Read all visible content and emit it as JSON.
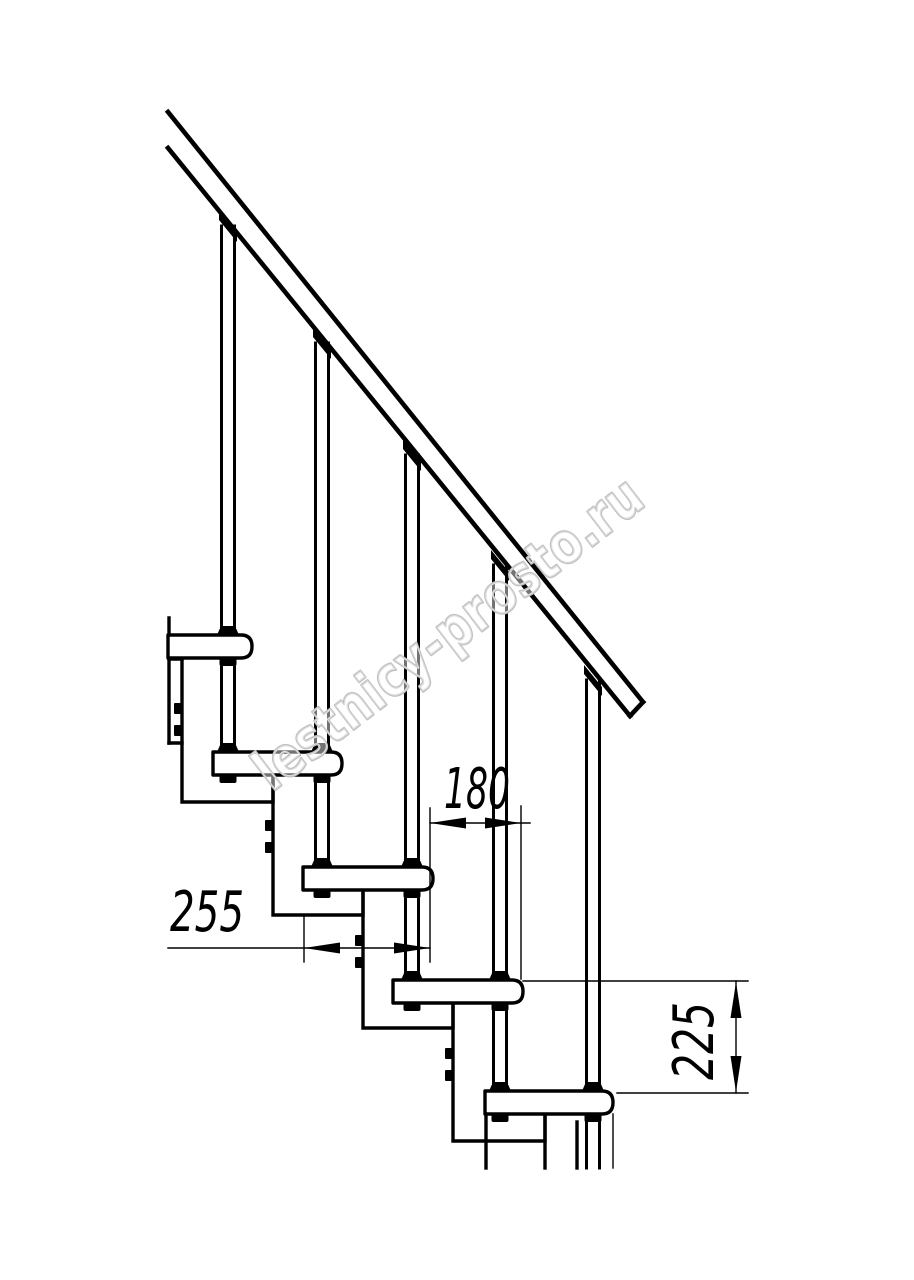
{
  "watermark": "lestnicy-prosto.ru",
  "dimensions": {
    "step_run": "180",
    "tread_depth": "255",
    "step_rise": "225"
  },
  "colors": {
    "line": "#000000",
    "watermark_outline": "#c1c1c1",
    "background": "#ffffff"
  }
}
